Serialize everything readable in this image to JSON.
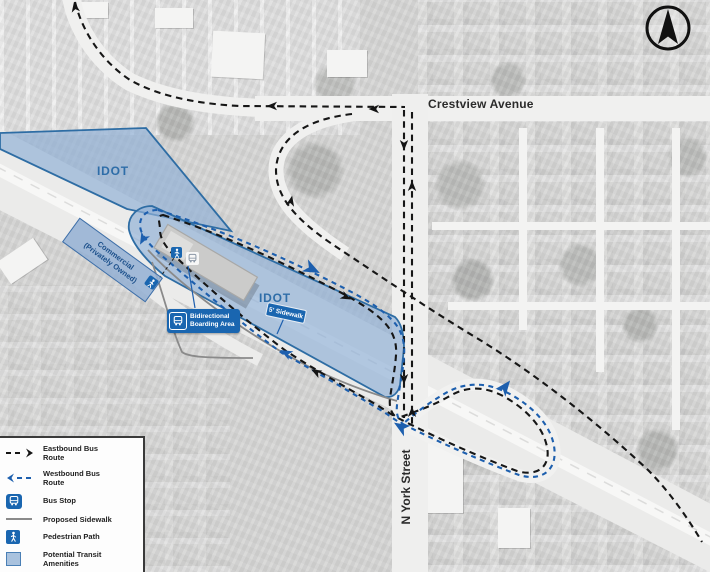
{
  "map": {
    "north_arrow": "north",
    "streets": {
      "crestview": "Crestview Avenue",
      "york": "N York Street"
    },
    "areas": {
      "idot_upper": "IDOT",
      "idot_lower": "IDOT",
      "commercial_line1": "Commercial",
      "commercial_line2": "(Privately Owned)"
    },
    "callouts": {
      "boarding_line1": "Bidirectional",
      "boarding_line2": "Boarding Area",
      "sidewalk": "5' Sidewalk"
    }
  },
  "legend": {
    "items": [
      {
        "symbol": "eastbound-route-symbol",
        "label": "Eastbound Bus Route"
      },
      {
        "symbol": "westbound-route-symbol",
        "label": "Westbound Bus Route"
      },
      {
        "symbol": "bus-stop-icon",
        "label": "Bus Stop"
      },
      {
        "symbol": "proposed-sidewalk-symbol",
        "label": "Proposed Sidewalk"
      },
      {
        "symbol": "pedestrian-path-icon",
        "label": "Pedestrian Path"
      },
      {
        "symbol": "transit-amenities-swatch",
        "label": "Potential Transit Amenities"
      }
    ]
  },
  "colors": {
    "eastbound_route": "#161616",
    "westbound_route": "#1d5fae",
    "idot_fill": "#8fb0d6",
    "idot_stroke": "#2e6da4",
    "callout_bg": "#1a66b0",
    "sidewalk_gray": "#8a8a8a",
    "photo_base": "#d6d6d5"
  }
}
